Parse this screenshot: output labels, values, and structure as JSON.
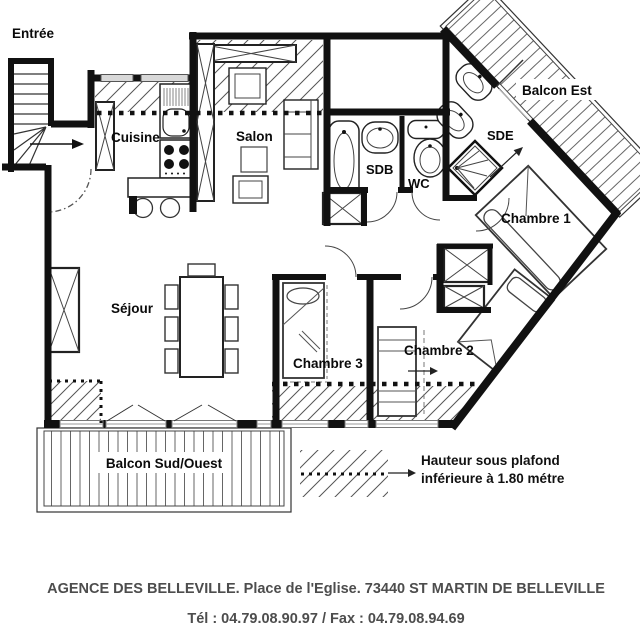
{
  "rooms": {
    "entree": "Entrée",
    "cuisine": "Cuisine",
    "salon": "Salon",
    "sejour": "Séjour",
    "sdb": "SDB",
    "wc": "WC",
    "sde": "SDE",
    "chambre1": "Chambre 1",
    "chambre2": "Chambre 2",
    "chambre3": "Chambre 3",
    "balcon_est": "Balcon Est",
    "balcon_sud_ouest": "Balcon Sud/Ouest"
  },
  "legend": {
    "line1": "Hauteur sous plafond",
    "line2": "inférieure à 1.80 métre"
  },
  "footer": {
    "line1": "AGENCE DES BELLEVILLE. Place de l'Eglise. 73440 ST MARTIN DE BELLEVILLE",
    "line2": "Tél : 04.79.08.90.97 / Fax : 04.79.08.94.69"
  },
  "colors": {
    "wall": "#111111",
    "hatch": "#555555",
    "window": "#999999",
    "footer_text": "#4d4d4d"
  }
}
